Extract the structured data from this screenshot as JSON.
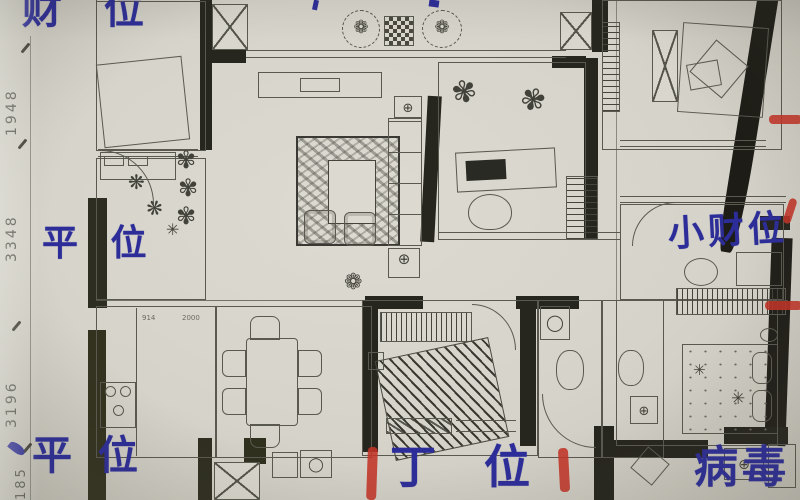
{
  "photo": {
    "description": "hand-annotated apartment floor plan photo",
    "ink_color": "#2d2d99",
    "red_mark_color": "#c23327"
  },
  "annotations": {
    "wealth_top_left": "财 位",
    "neutral_mid_left": "平 位",
    "small_wealth_right": "小财位",
    "neutral_bottom_left": "平 位",
    "ding_bottom_center": "丁 位",
    "virus_bottom_right": "病毒"
  },
  "dimensions": {
    "left_top": "1948",
    "left_upper": "3348",
    "left_lower": "3196",
    "left_bottom": "185",
    "kitchen_a": "914",
    "kitchen_b": "2000"
  },
  "glyphs": {
    "plant": "✾",
    "flower": "❁",
    "blossom": "❋",
    "star": "✳",
    "crosshair": "⊕",
    "circle": "◯"
  }
}
